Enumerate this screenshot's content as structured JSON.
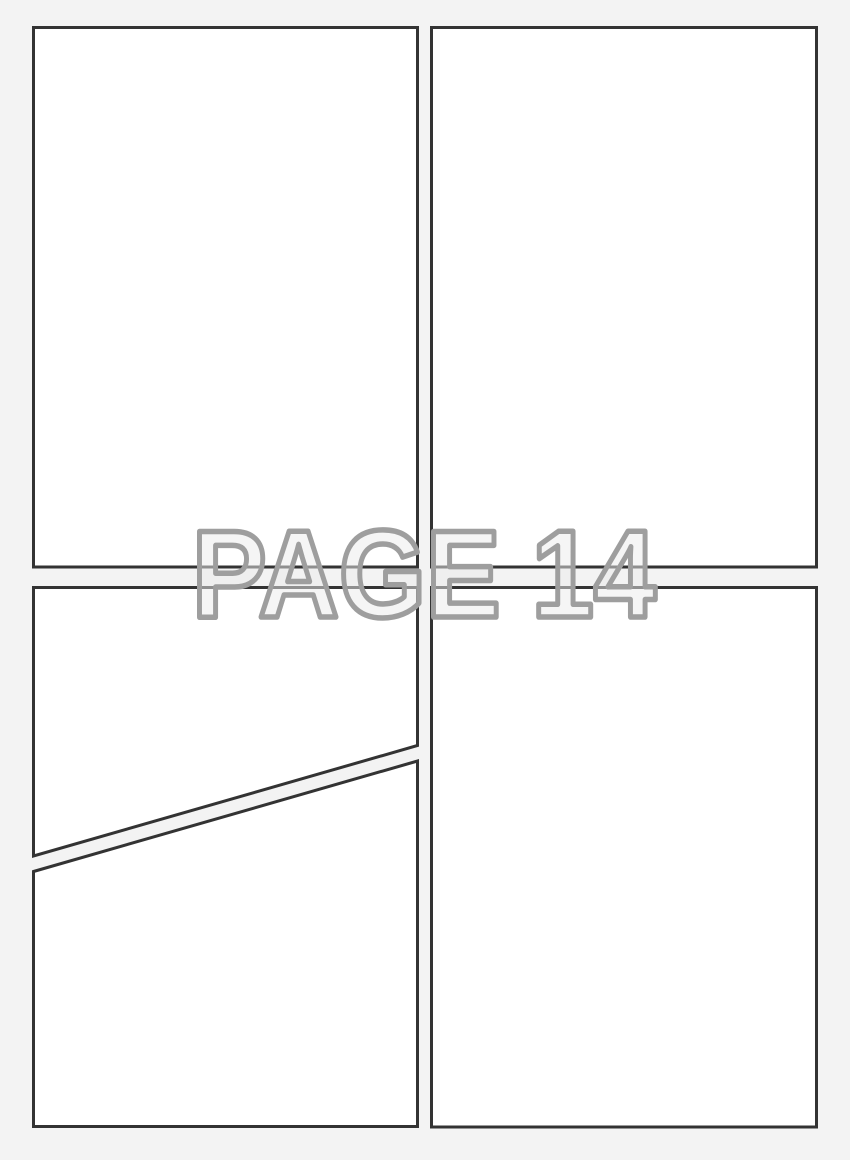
{
  "page": {
    "watermark_text": "PAGE 14",
    "page_number": "14",
    "colors": {
      "background": "#f3f3f3",
      "panel_fill": "#ffffff",
      "panel_border": "#333333",
      "watermark_outline": "#9e9e9e",
      "watermark_fill": "rgba(235,235,235,0.5)"
    },
    "panels": [
      {
        "id": "panel-top-left"
      },
      {
        "id": "panel-top-right"
      },
      {
        "id": "panel-bottom-left-upper"
      },
      {
        "id": "panel-bottom-left-lower"
      },
      {
        "id": "panel-bottom-right"
      }
    ]
  }
}
